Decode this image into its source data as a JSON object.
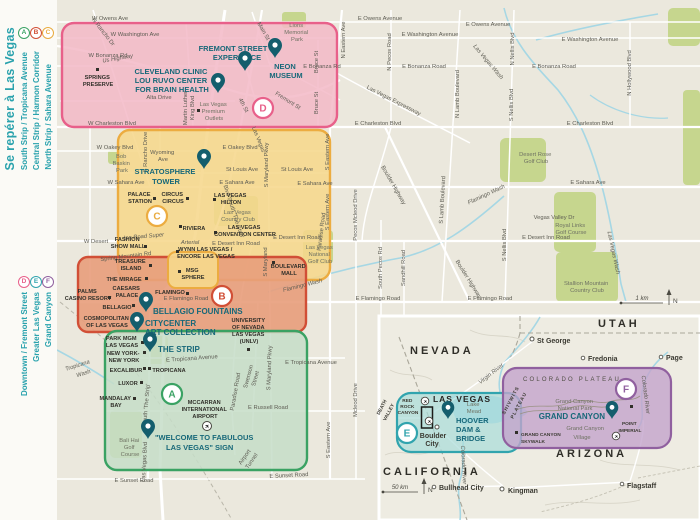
{
  "sidebar": {
    "title": "Se repérer à Las Vegas",
    "legend_top": [
      {
        "letter": "A",
        "label": "South Strip / Tropicana Avenue",
        "color": "#3aa263"
      },
      {
        "letter": "B",
        "label": "Central Strip / Harmon Corridor",
        "color": "#d14f36"
      },
      {
        "letter": "C",
        "label": "North Strip / Sahara Avenue",
        "color": "#e9ab3f"
      }
    ],
    "legend_bottom": [
      {
        "letter": "D",
        "label": "Downtown / Fremont Street",
        "color": "#e8608a"
      },
      {
        "letter": "E",
        "label": "Greater Las Vegas",
        "color": "#31a4ae"
      },
      {
        "letter": "F",
        "label": "Grand Canyon",
        "color": "#90609f"
      }
    ]
  },
  "palette": {
    "pink_fill": "#f3b8c7",
    "yellow_fill": "#f6d78c",
    "orange_fill": "#e89d7b",
    "green_fill": "#c6ddc8",
    "teal_fill": "#abdcda",
    "purple_fill": "#c3a4cc",
    "pin": "#145e6d",
    "water": "#a6d7e4",
    "park": "#c6d68e",
    "bg": "#ebe8dd"
  },
  "roads": {
    "owens_w": "W Owens Ave",
    "owens_e": "E Owens Avenue",
    "washington_w": "W Washington Ave",
    "washington_e": "E Washington Avenue",
    "bonanza_w": "W Bonanza Rd",
    "bonanza_e_short": "E Bonanza Rd",
    "bonanza_e": "E Bonanza Road",
    "us_highway": "Us Highway",
    "charleston_w": "W Charleston Blvd",
    "charleston_e": "E Charleston Blvd",
    "alta": "Alta Drive",
    "oakey_w": "W Oakey Blvd",
    "oakey_e": "E Oakey Blvd",
    "st_louis": "St Louis Ave",
    "sahara_w": "W Sahara Ave",
    "sahara_e": "E Sahara Ave",
    "wyoming": [
      "Wyoming",
      "Ave"
    ],
    "spring_mountain": "Spring Mountain Rd",
    "desert_inn_w": "W Desert",
    "desert_inn_super": "Inn Road Super",
    "desert_inn_arterial": "Arterial",
    "desert_inn_e": "E Desert Inn Road",
    "flamingo_e": "E Flamingo Road",
    "tropicana_e": "E Tropicana Avenue",
    "russell": "E Russell Road",
    "sunset": "E Sunset Road",
    "rancho_n": "N Rancho Dr",
    "rancho_s": "S Rancho Drive",
    "mlk": [
      "Martin Luther",
      "King Blvd"
    ],
    "main_st": "Main St",
    "fourth_st": "4th St",
    "fremont_st": "Fremont St",
    "bruce_st": "Bruce St",
    "eastern_n": "N Eastern Ave",
    "eastern_s": "S Eastern Ave",
    "maryland_pkwy": "S Maryland Pkwy",
    "maryland": "S Maryland",
    "paradise": "Paradise Road",
    "swenson": [
      "Swenson",
      "Street"
    ],
    "airport_tunnel": [
      "Airport",
      "Tunnel"
    ],
    "lv_blvd_1": "Las Vegas",
    "lv_blvd_2": "Blvd South 'The Strip'",
    "lv_blvd_3": "South 'The Strip'",
    "lv_blvd_4": "Las Vegas Blvd",
    "pecos_mcleod": "Pecos Mcleod Drive",
    "mcleod": "Mcleod Drive",
    "pecos_n": "N Pecos Road",
    "pecos_s": "South Pecos Rd",
    "sandhill": "Sandhill Road",
    "lamb_n": "N Lamb Boulevard",
    "lamb_s": "S Lamb Boulevard",
    "nellis_n": "N Nellis Blvd",
    "nellis_s": "S Nellis Blvd",
    "hollywood": "N Hollywood Blvd",
    "boulder_hwy": "Boulder Highway",
    "expressway": "Las Vegas Expressway",
    "vegas_valley": "Vegas Valley Dr",
    "lv_wash": "Las Vegas Wash",
    "flamingo_wash": "Flamingo Wash",
    "tropicana_wash": [
      "Tropicana",
      "Wash"
    ]
  },
  "parks": {
    "lions": [
      "Lions",
      "Memorial",
      "Park"
    ],
    "bob_baskin": [
      "Bob",
      "Baskin",
      "Park"
    ],
    "lv_country_club": [
      "Las Vegas",
      "Country Club"
    ],
    "lv_national": [
      "Las Vegas",
      "National",
      "Golf Club"
    ],
    "desert_rose": [
      "Desert Rose",
      "Golf Club"
    ],
    "royal_links": [
      "Royal Links",
      "Golf Course"
    ],
    "stallion": [
      "Stallion Mountain",
      "Country Club"
    ],
    "bali_hai": [
      "Bali Hai",
      "Golf",
      "Course"
    ]
  },
  "pois": {
    "springs": [
      "SPRINGS",
      "PRESERVE"
    ],
    "outlets": [
      "Las Vegas",
      "Premium",
      "Outlets"
    ],
    "palace_station": [
      "PALACE",
      "STATION"
    ],
    "circus": [
      "CIRCUS",
      "CIRCUS"
    ],
    "hilton": [
      "LAS VEGAS",
      "HILTON"
    ],
    "riviera": "RIVIERA",
    "convention": [
      "LAS VEGAS",
      "CONVENTION CENTER"
    ],
    "fashion_show": [
      "FASHION",
      "SHOW MALL"
    ],
    "wynn": [
      "WYNN LAS VEGAS /",
      "ENCORE LAS VEGAS"
    ],
    "msg": [
      "MSG",
      "SPHERE"
    ],
    "boulevard_mall": [
      "BOULEVARD",
      "MALL"
    ],
    "treasure_island": [
      "TREASURE",
      "ISLAND"
    ],
    "mirage": "THE MIRAGE",
    "caesars": [
      "CAESARS",
      "PALACE"
    ],
    "palms": [
      "PALMS",
      "CASINO RESORT"
    ],
    "flamingo": "FLAMINGO",
    "bellagio": "BELLAGIO",
    "cosmopolitan": [
      "COSMOPOLITAN",
      "OF LAS VEGAS"
    ],
    "park_mgm": [
      "PARK MGM",
      "LAS VEGAS"
    ],
    "nyny": [
      "NEW YORK-",
      "NEW YORK"
    ],
    "excalibur": "EXCALIBUR",
    "luxor": "LUXOR",
    "mandalay": [
      "MANDALAY",
      "BAY"
    ],
    "tropicana": "TROPICANA",
    "mccarran": [
      "MCCARRAN",
      "INTERNATIONAL",
      "AIRPORT"
    ],
    "unlv": [
      "UNIVERSITY",
      "OF NEVADA",
      "LAS VEGAS",
      "(UNLV)"
    ]
  },
  "attractions": {
    "fremont": [
      "FREMONT STREET",
      "EXPERIENCE"
    ],
    "neon": [
      "NEON",
      "MUSEUM"
    ],
    "cleveland": [
      "CLEVELAND CLINIC",
      "LOU RUVO CENTER",
      "FOR BRAIN HEALTH"
    ],
    "stratosphere": [
      "STRATOSPHERE",
      "TOWER"
    ],
    "bellagio_fountains": "BELLAGIO FOUNTAINS",
    "citycenter": [
      "CITYCENTER",
      "ART COLLECTION"
    ],
    "the_strip": "THE STRIP",
    "welcome_sign": [
      "\"WELCOME TO FABULOUS",
      "LAS VEGAS\" SIGN"
    ]
  },
  "inset": {
    "states": {
      "nevada": "NEVADA",
      "california": "CALIFORNIA",
      "arizona": "ARIZONA",
      "utah": "UTAH"
    },
    "cities": {
      "st_george": "St George",
      "fredonia": "Fredonia",
      "page": "Page",
      "kingman": "Kingman",
      "flagstaff": "Flagstaff",
      "bullhead": "Bullhead City",
      "boulder_city": [
        "Boulder",
        "City"
      ]
    },
    "labels": {
      "death_valley": [
        "DEATH",
        "VALLEY"
      ],
      "red_rock": [
        "RED",
        "ROCK",
        "CANYON"
      ],
      "las_vegas": "LAS VEGAS",
      "lake_mead": [
        "Lake",
        "Mead"
      ],
      "virgin_river": "Virgin River",
      "colorado_river": "Colorado River",
      "colorado_plateau": "COLORADO PLATEAU",
      "shivwits": [
        "SHIVWITS",
        "PLATEAU"
      ],
      "gc_park": [
        "Grand Canyon",
        "National Park"
      ],
      "grand_canyon": "GRAND CANYON",
      "point_imperial": [
        "POINT",
        "IMPERIAL"
      ],
      "gc_village": [
        "Grand Canyon",
        "Village"
      ],
      "skywalk": [
        "GRAND CANYON",
        "SKYWALK"
      ],
      "hoover": [
        "HOOVER",
        "DAM &",
        "BRIDGE"
      ]
    }
  },
  "scale": {
    "main": "1 km",
    "inset": "50 km",
    "north": "N"
  }
}
